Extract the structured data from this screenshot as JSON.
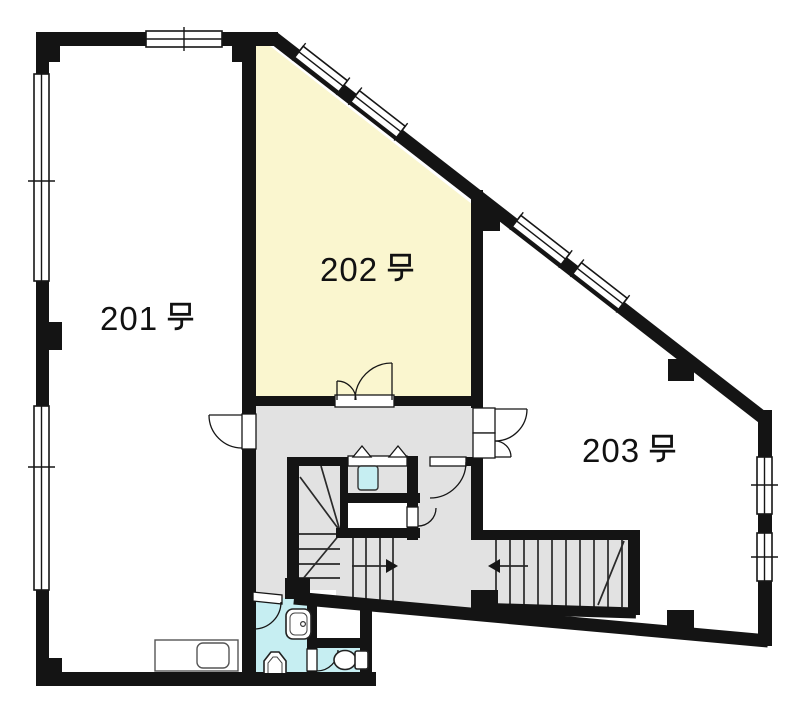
{
  "plan": {
    "type": "building-floor-plan",
    "rooms": [
      {
        "id": "201",
        "label": "201号",
        "highlighted": false
      },
      {
        "id": "202",
        "label": "202号",
        "highlighted": true
      },
      {
        "id": "203",
        "label": "203号",
        "highlighted": false
      }
    ],
    "colors": {
      "wall": "#141414",
      "room_default": "#ffffff",
      "room_highlight": "#faf6cf",
      "common_area": "#e2e2e2",
      "wet_area": "#c6eef2"
    },
    "stairs": [
      {
        "name": "main-staircase",
        "direction_arrow": "right"
      },
      {
        "name": "side-staircase",
        "direction_arrow": "left"
      }
    ],
    "doors": [
      "room-201-door",
      "room-202-double-door",
      "room-203-double-door",
      "vestibule-door",
      "wc-booth-doors",
      "bathroom-door",
      "toilet-door",
      "storage-door"
    ],
    "windows": [
      "top-window",
      "left-upper-window",
      "left-lower-window",
      "diagonal-window-1",
      "diagonal-window-2",
      "diagonal-window-3",
      "diagonal-window-4",
      "right-upper-window",
      "right-lower-window"
    ],
    "fixtures": [
      "kitchen-counter",
      "bathroom-sink",
      "toilet",
      "toilet-2",
      "wc-basin"
    ]
  }
}
